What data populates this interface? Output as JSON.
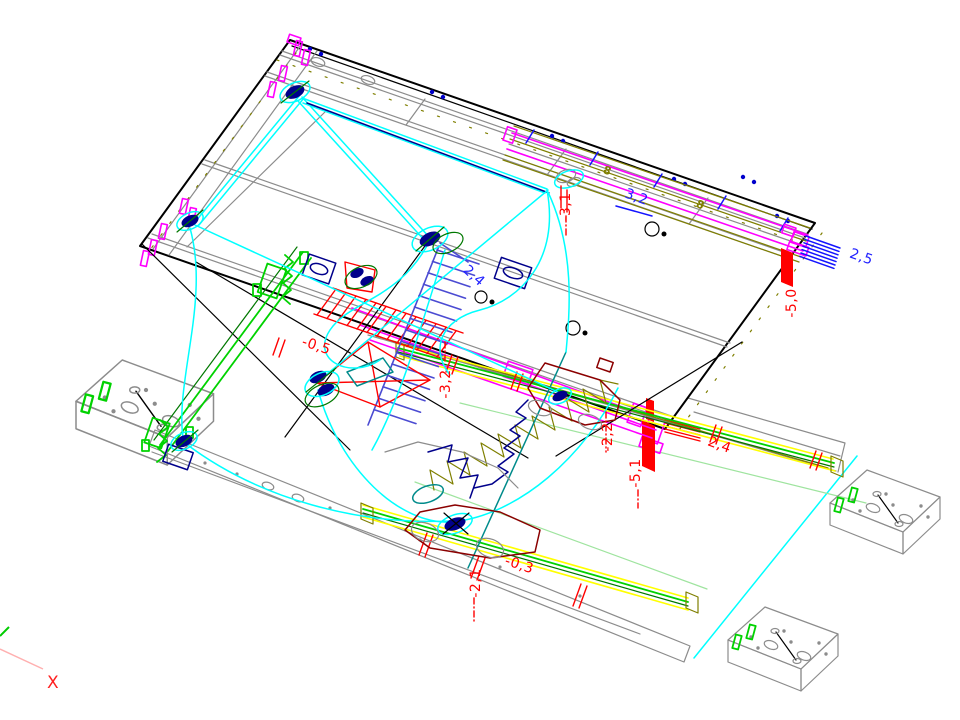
{
  "drawing": {
    "background": "#ffffff",
    "dimension_labels": [
      {
        "id": "dim-2-5",
        "text": "2,5",
        "color": "#2222ff"
      },
      {
        "id": "dim-m5-0",
        "text": "-5,0",
        "color": "#ff0000"
      },
      {
        "id": "dim-m3-1",
        "text": "-3,1",
        "color": "#ff0000"
      },
      {
        "id": "dim-3-2",
        "text": "3,2",
        "color": "#2222ff"
      },
      {
        "id": "dim-2-4b",
        "text": "2,4",
        "color": "#2222ff"
      },
      {
        "id": "dim-m3-2",
        "text": "-3,2",
        "color": "#ff0000"
      },
      {
        "id": "dim-m2-2",
        "text": "-2,2",
        "color": "#ff0000"
      },
      {
        "id": "dim-m5-1",
        "text": "-5,1",
        "color": "#ff0000"
      },
      {
        "id": "dim-2-4r",
        "text": "2,4",
        "color": "#ff0000"
      },
      {
        "id": "dim-m0-5",
        "text": "-0,5",
        "color": "#ff0000"
      },
      {
        "id": "dim-m0-3",
        "text": "-0,3",
        "color": "#ff0000"
      },
      {
        "id": "dim-m2-1",
        "text": "-2,1",
        "color": "#ff0000"
      }
    ],
    "marker_labels": [
      {
        "id": "rail-mark-1",
        "text": "8",
        "color": "#7f7f00"
      },
      {
        "id": "rail-mark-2",
        "text": "8",
        "color": "#7f7f00"
      }
    ],
    "axis_indicator": {
      "x_label": "X",
      "x_color": "#ff2020",
      "y_color": "#00cc00"
    },
    "palette": {
      "outline": "#000000",
      "steel": "#8c8c8c",
      "cable": "#00ffff",
      "rope": "#008b8b",
      "bracket": "#ff00ff",
      "rail_yellow": "#ffff00",
      "rail_green": "#00d200",
      "chain": "#7f7f00",
      "pulley": "#00008b",
      "hatch_blue": "#4b4bd2",
      "hatch_red": "#ff0000",
      "carriage": "#8b0000"
    }
  }
}
